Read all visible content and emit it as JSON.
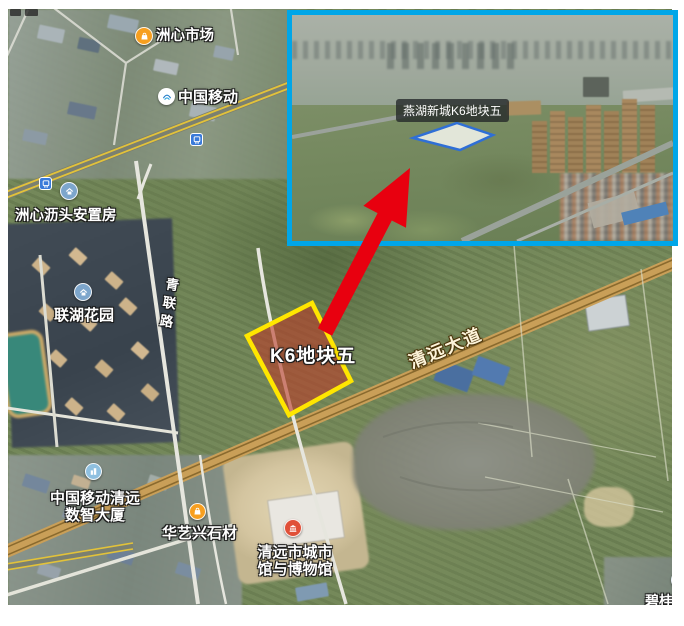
{
  "map": {
    "poi_market": "洲心市场",
    "poi_china_mobile": "中国移动",
    "poi_resettlement": "洲心沥头安置房",
    "poi_lianhu_garden": "联湖花园",
    "poi_cmcc_tower_line1": "中国移动清远",
    "poi_cmcc_tower_line2": "数智大厦",
    "poi_stone": "华艺兴石材",
    "poi_museum_line1": "清远市城市",
    "poi_museum_line2": "馆与博物馆",
    "poi_partial_bottom_right": "碧桂园",
    "road_qinglian": "青联路",
    "road_qingyuan": "清远大道",
    "plot_label": "K6地块五"
  },
  "inset": {
    "caption": "燕湖新城K6地块五"
  },
  "icons": {
    "market": "shopping-bag-icon",
    "china_mobile": "china-mobile-logo-icon",
    "housing": "house-icon",
    "company": "building-icon",
    "museum": "museum-icon",
    "transit": "bus-station-icon"
  },
  "colors": {
    "inset_border": "#00a6e8",
    "plot_outline": "#ffe600",
    "plot_fill": "rgba(186,60,42,0.6)",
    "arrow_red": "#e8000f",
    "highway_yellow": "#e2c23a",
    "avenue_tan": "#c99f58",
    "inset_plot_outline": "#2f6fd6"
  }
}
